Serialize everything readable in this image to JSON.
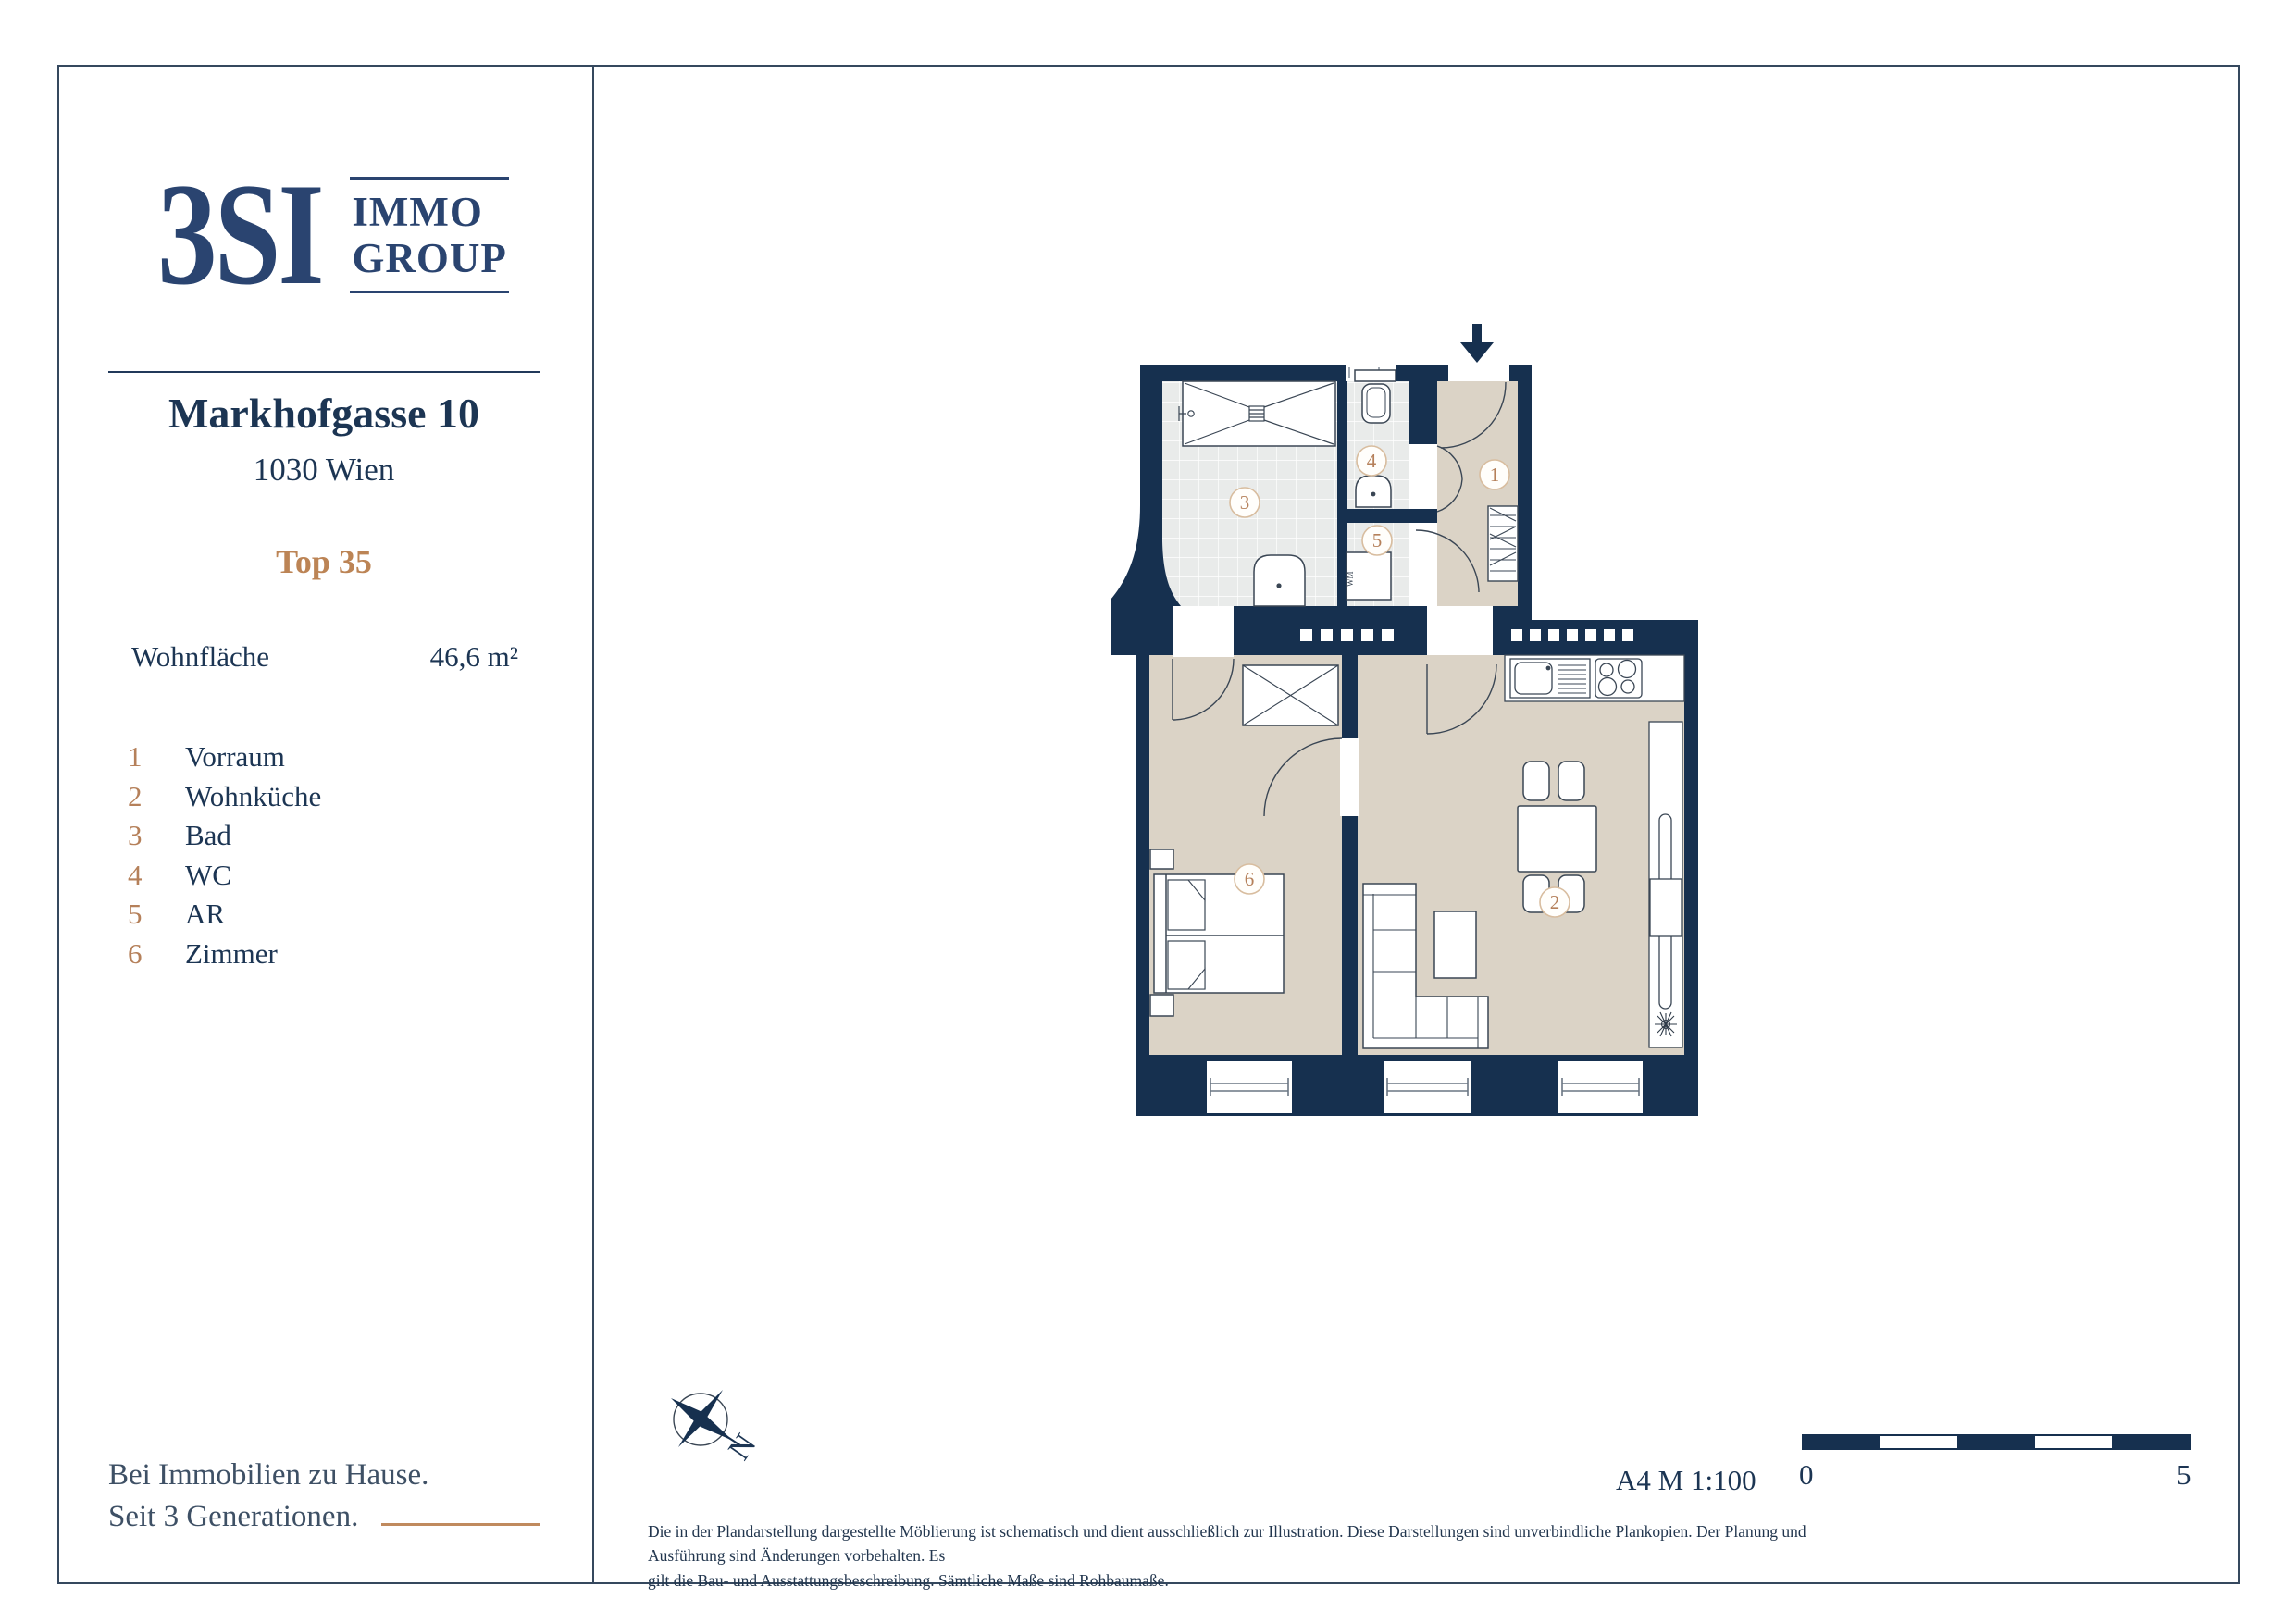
{
  "brand": {
    "logo_text": "3SI",
    "logo_sub_line1": "IMMO",
    "logo_sub_line2": "GROUP"
  },
  "property": {
    "address_line1": "Markhofgasse 10",
    "address_line2": "1030 Wien",
    "unit": "Top 35",
    "area_label": "Wohnfläche",
    "area_value": "46,6 m²"
  },
  "legend": {
    "items": [
      {
        "number": "1",
        "label": "Vorraum"
      },
      {
        "number": "2",
        "label": "Wohnküche"
      },
      {
        "number": "3",
        "label": "Bad"
      },
      {
        "number": "4",
        "label": "WC"
      },
      {
        "number": "5",
        "label": "AR"
      },
      {
        "number": "6",
        "label": "Zimmer"
      }
    ]
  },
  "plan": {
    "room_labels": [
      "1",
      "2",
      "3",
      "4",
      "5",
      "6"
    ],
    "wm_label": "WM",
    "compass_label": "N",
    "meta": "A4  M 1:100",
    "scale_start": "0",
    "scale_end": "5"
  },
  "footer": {
    "tagline_line1": "Bei Immobilien zu Hause.",
    "tagline_line2": "Seit 3 Generationen.",
    "disclaimer_line1": "Die in der Plandarstellung dargestellte Möblierung ist schematisch und dient ausschließlich zur Illustration. Diese Darstellungen sind unverbindliche Plankopien. Der Planung und Ausführung sind Änderungen vorbehalten. Es",
    "disclaimer_line2": "gilt die Bau- und Ausstattungsbeschreibung. Sämtliche Maße sind Rohbaumaße."
  },
  "colors": {
    "wall_navy": "#16304F",
    "floor_beige": "#DBD3C6",
    "tile_gray": "#E9EBEA",
    "bronze": "#B5805A",
    "text_navy": "#1C3553"
  }
}
